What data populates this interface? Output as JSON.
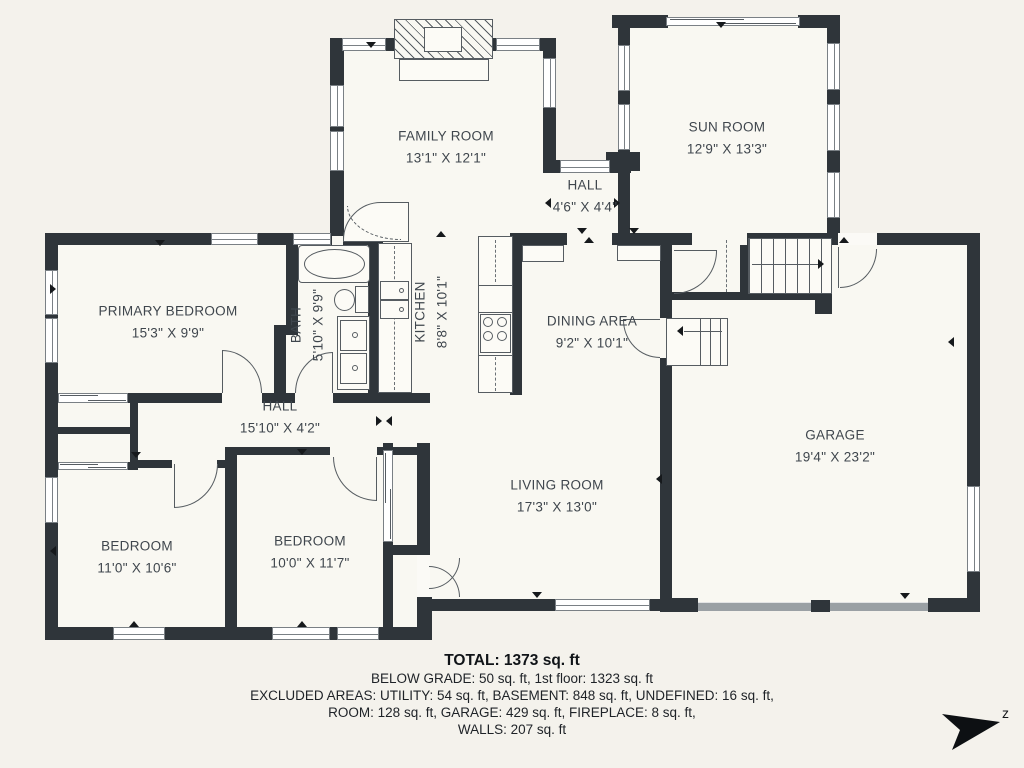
{
  "rooms": [
    {
      "name": "FAMILY ROOM",
      "dims": "13'1\" X 12'1\""
    },
    {
      "name": "SUN ROOM",
      "dims": "12'9\" X 13'3\""
    },
    {
      "name": "HALL",
      "dims": "4'6\" X 4'4\""
    },
    {
      "name": "PRIMARY BEDROOM",
      "dims": "15'3\" X 9'9\""
    },
    {
      "name": "BATH",
      "dims": "5'10\" X 9'9\""
    },
    {
      "name": "KITCHEN",
      "dims": "8'8\" X 10'1\""
    },
    {
      "name": "DINING AREA",
      "dims": "9'2\" X 10'1\""
    },
    {
      "name": "HALL",
      "dims": "15'10\" X 4'2\""
    },
    {
      "name": "GARAGE",
      "dims": "19'4\" X 23'2\""
    },
    {
      "name": "LIVING ROOM",
      "dims": "17'3\" X 13'0\""
    },
    {
      "name": "BEDROOM",
      "dims": "11'0\" X 10'6\""
    },
    {
      "name": "BEDROOM",
      "dims": "10'0\" X 11'7\""
    }
  ],
  "summary": {
    "total": "TOTAL: 1373 sq. ft",
    "below_grade": "BELOW GRADE: 50 sq. ft, 1st floor: 1323 sq. ft",
    "excluded_1": "EXCLUDED AREAS: UTILITY: 54 sq. ft, BASEMENT: 848 sq. ft, UNDEFINED: 16 sq. ft,",
    "excluded_2": "ROOM: 128 sq. ft, GARAGE: 429 sq. ft, FIREPLACE: 8 sq. ft,",
    "walls": "WALLS: 207 sq. ft"
  },
  "compass": {
    "label": "z"
  },
  "colors": {
    "background": "#f4f2ec",
    "floor": "#f9f8f2",
    "wall": "#2f353a",
    "fixture_line": "#565c61",
    "garage_door": "#9aa0a4",
    "label_text": "#3f464d"
  }
}
